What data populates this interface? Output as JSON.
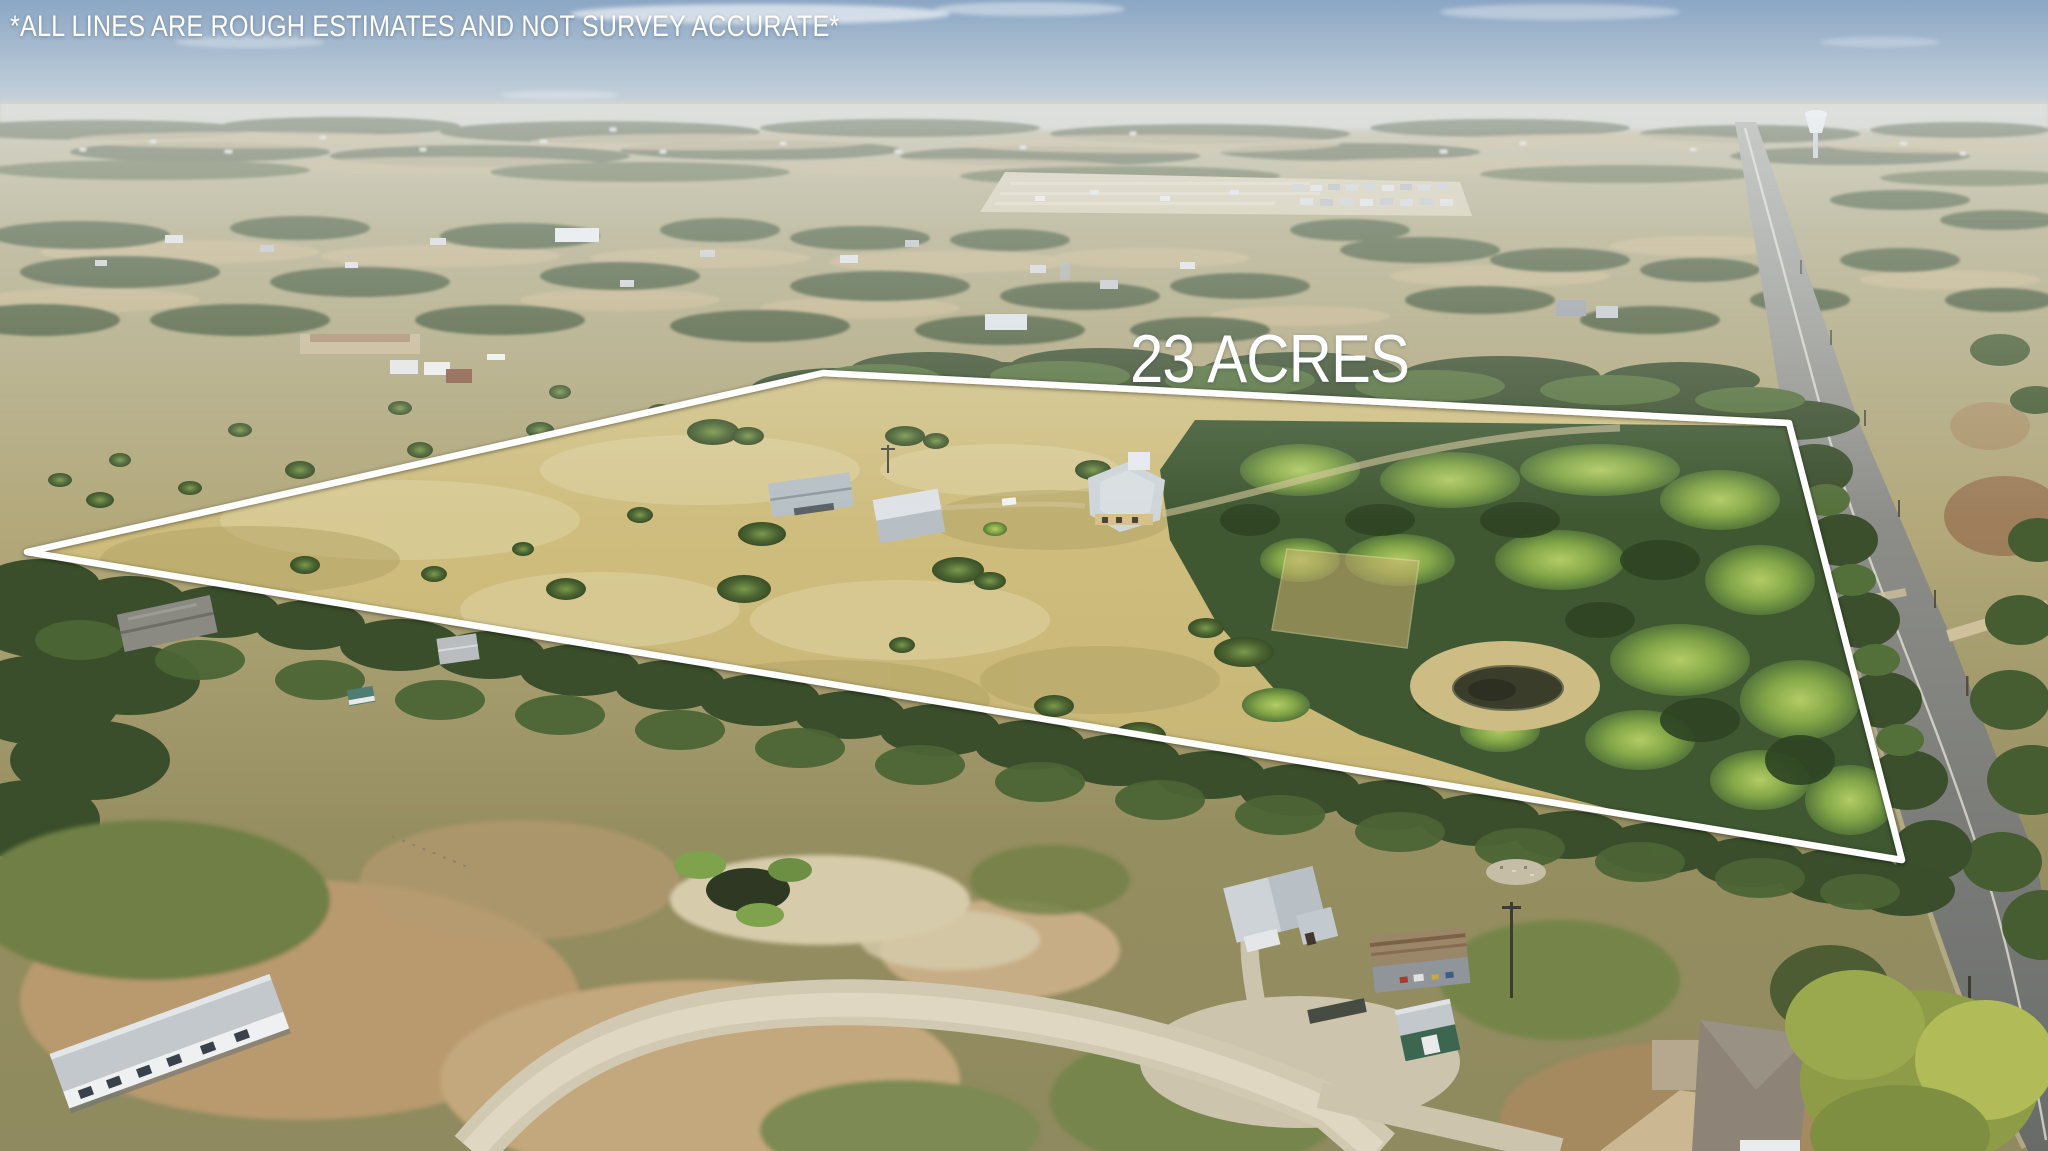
{
  "overlay": {
    "disclaimer": "*ALL LINES ARE ROUGH ESTIMATES AND NOT SURVEY ACCURATE*",
    "acreage_label": "23 ACRES",
    "text_color": "#ffffff"
  },
  "scene": {
    "type": "aerial-drone-photograph",
    "description": "Aerial real-estate photo of a 23-acre rural Texas property outlined in white: tan pasture with scattered oaks, farmhouse and two metal barns in the center, dense woodland and a pond on the east side, a two-lane highway along the right edge, neighboring homesteads, sheds and a mobile home in the foreground, distant subdivision and water tower on the horizon",
    "boundary_color": "#ffffff",
    "palette": {
      "sky": "#8ba6c4",
      "haze": "#d8dde0",
      "pasture": "#cbb97a",
      "trees_dark": "#3f5230",
      "trees_bright": "#7da047",
      "dirt": "#b59a6f",
      "gravel": "#d2c9b3",
      "asphalt": "#7d7f7c",
      "pond": "#3b3d2b"
    },
    "features": [
      "property-boundary",
      "farmhouse",
      "metal-barns",
      "pond",
      "oak-groves",
      "woodland",
      "highway",
      "water-tower",
      "subdivision",
      "neighboring-homes",
      "gravel-drive",
      "mobile-home",
      "sheds"
    ]
  }
}
